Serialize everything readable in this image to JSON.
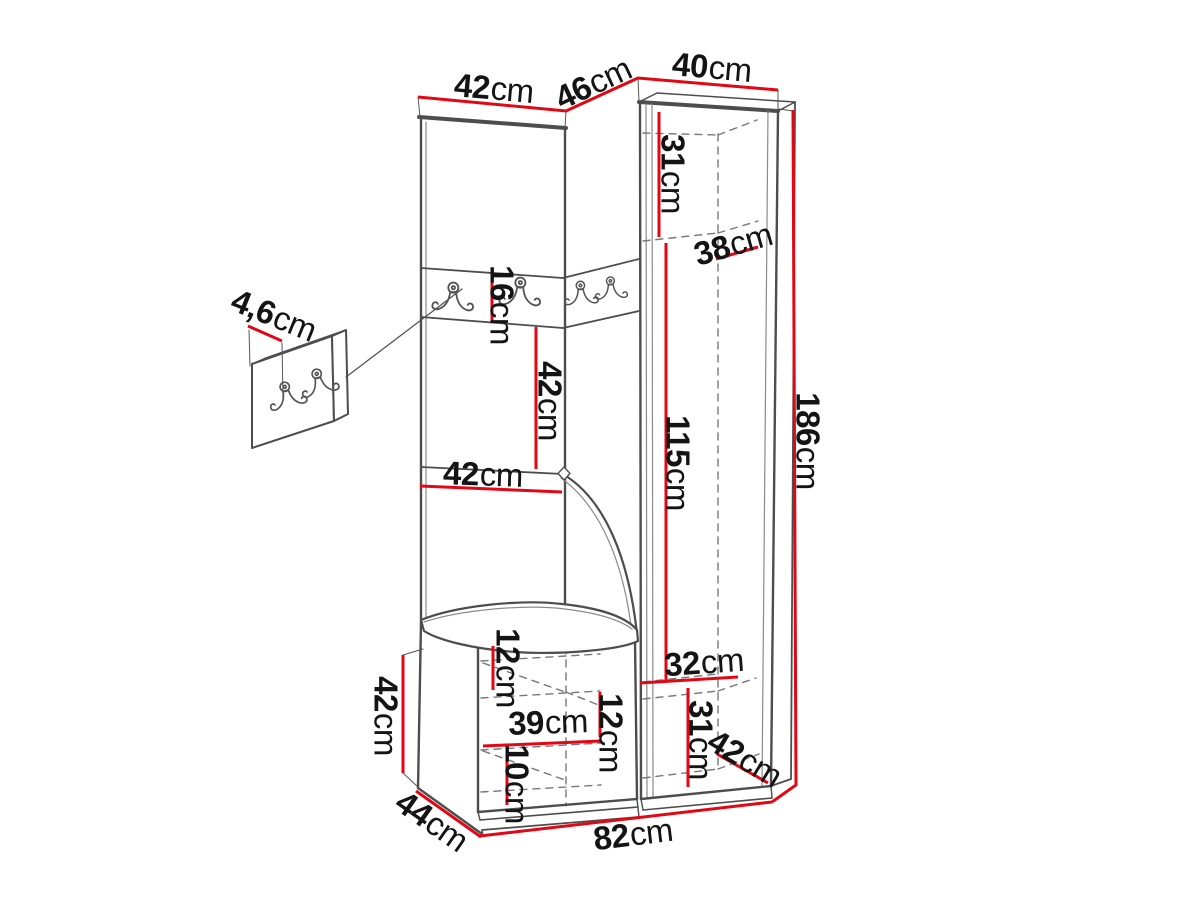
{
  "diagram": {
    "kind": "furniture-dimension-diagram",
    "unit": "cm",
    "colors": {
      "dimension_line": "#e30613",
      "drawing_line": "#4d4d4d",
      "text": "#141414",
      "background": "#ffffff"
    },
    "icons": {
      "coat_hook": "double-coat-hook"
    }
  },
  "dims": {
    "top_width_left": {
      "value": "42",
      "unit": "cm"
    },
    "top_width_middle": {
      "value": "46",
      "unit": "cm"
    },
    "top_width_right": {
      "value": "40",
      "unit": "cm"
    },
    "upper_inner_height": {
      "value": "31",
      "unit": "cm"
    },
    "upper_depth": {
      "value": "38",
      "unit": "cm"
    },
    "total_height": {
      "value": "186",
      "unit": "cm"
    },
    "hook_rail_height": {
      "value": "16",
      "unit": "cm"
    },
    "niche_height": {
      "value": "42",
      "unit": "cm"
    },
    "niche_width": {
      "value": "42",
      "unit": "cm"
    },
    "tall_inner_height": {
      "value": "115",
      "unit": "cm"
    },
    "wall_panel_depth": {
      "value": "4,6",
      "unit": "cm"
    },
    "bench_height": {
      "value": "42",
      "unit": "cm"
    },
    "bench_depth": {
      "value": "44",
      "unit": "cm"
    },
    "base_width": {
      "value": "82",
      "unit": "cm"
    },
    "bench_top_inset": {
      "value": "12",
      "unit": "cm"
    },
    "bench_inner_width": {
      "value": "39",
      "unit": "cm"
    },
    "bench_inner_height": {
      "value": "12",
      "unit": "cm"
    },
    "bench_bottom_inset": {
      "value": "10",
      "unit": "cm"
    },
    "lower_inner_width": {
      "value": "32",
      "unit": "cm"
    },
    "lower_inner_height": {
      "value": "31",
      "unit": "cm"
    },
    "lower_depth": {
      "value": "42",
      "unit": "cm"
    }
  }
}
